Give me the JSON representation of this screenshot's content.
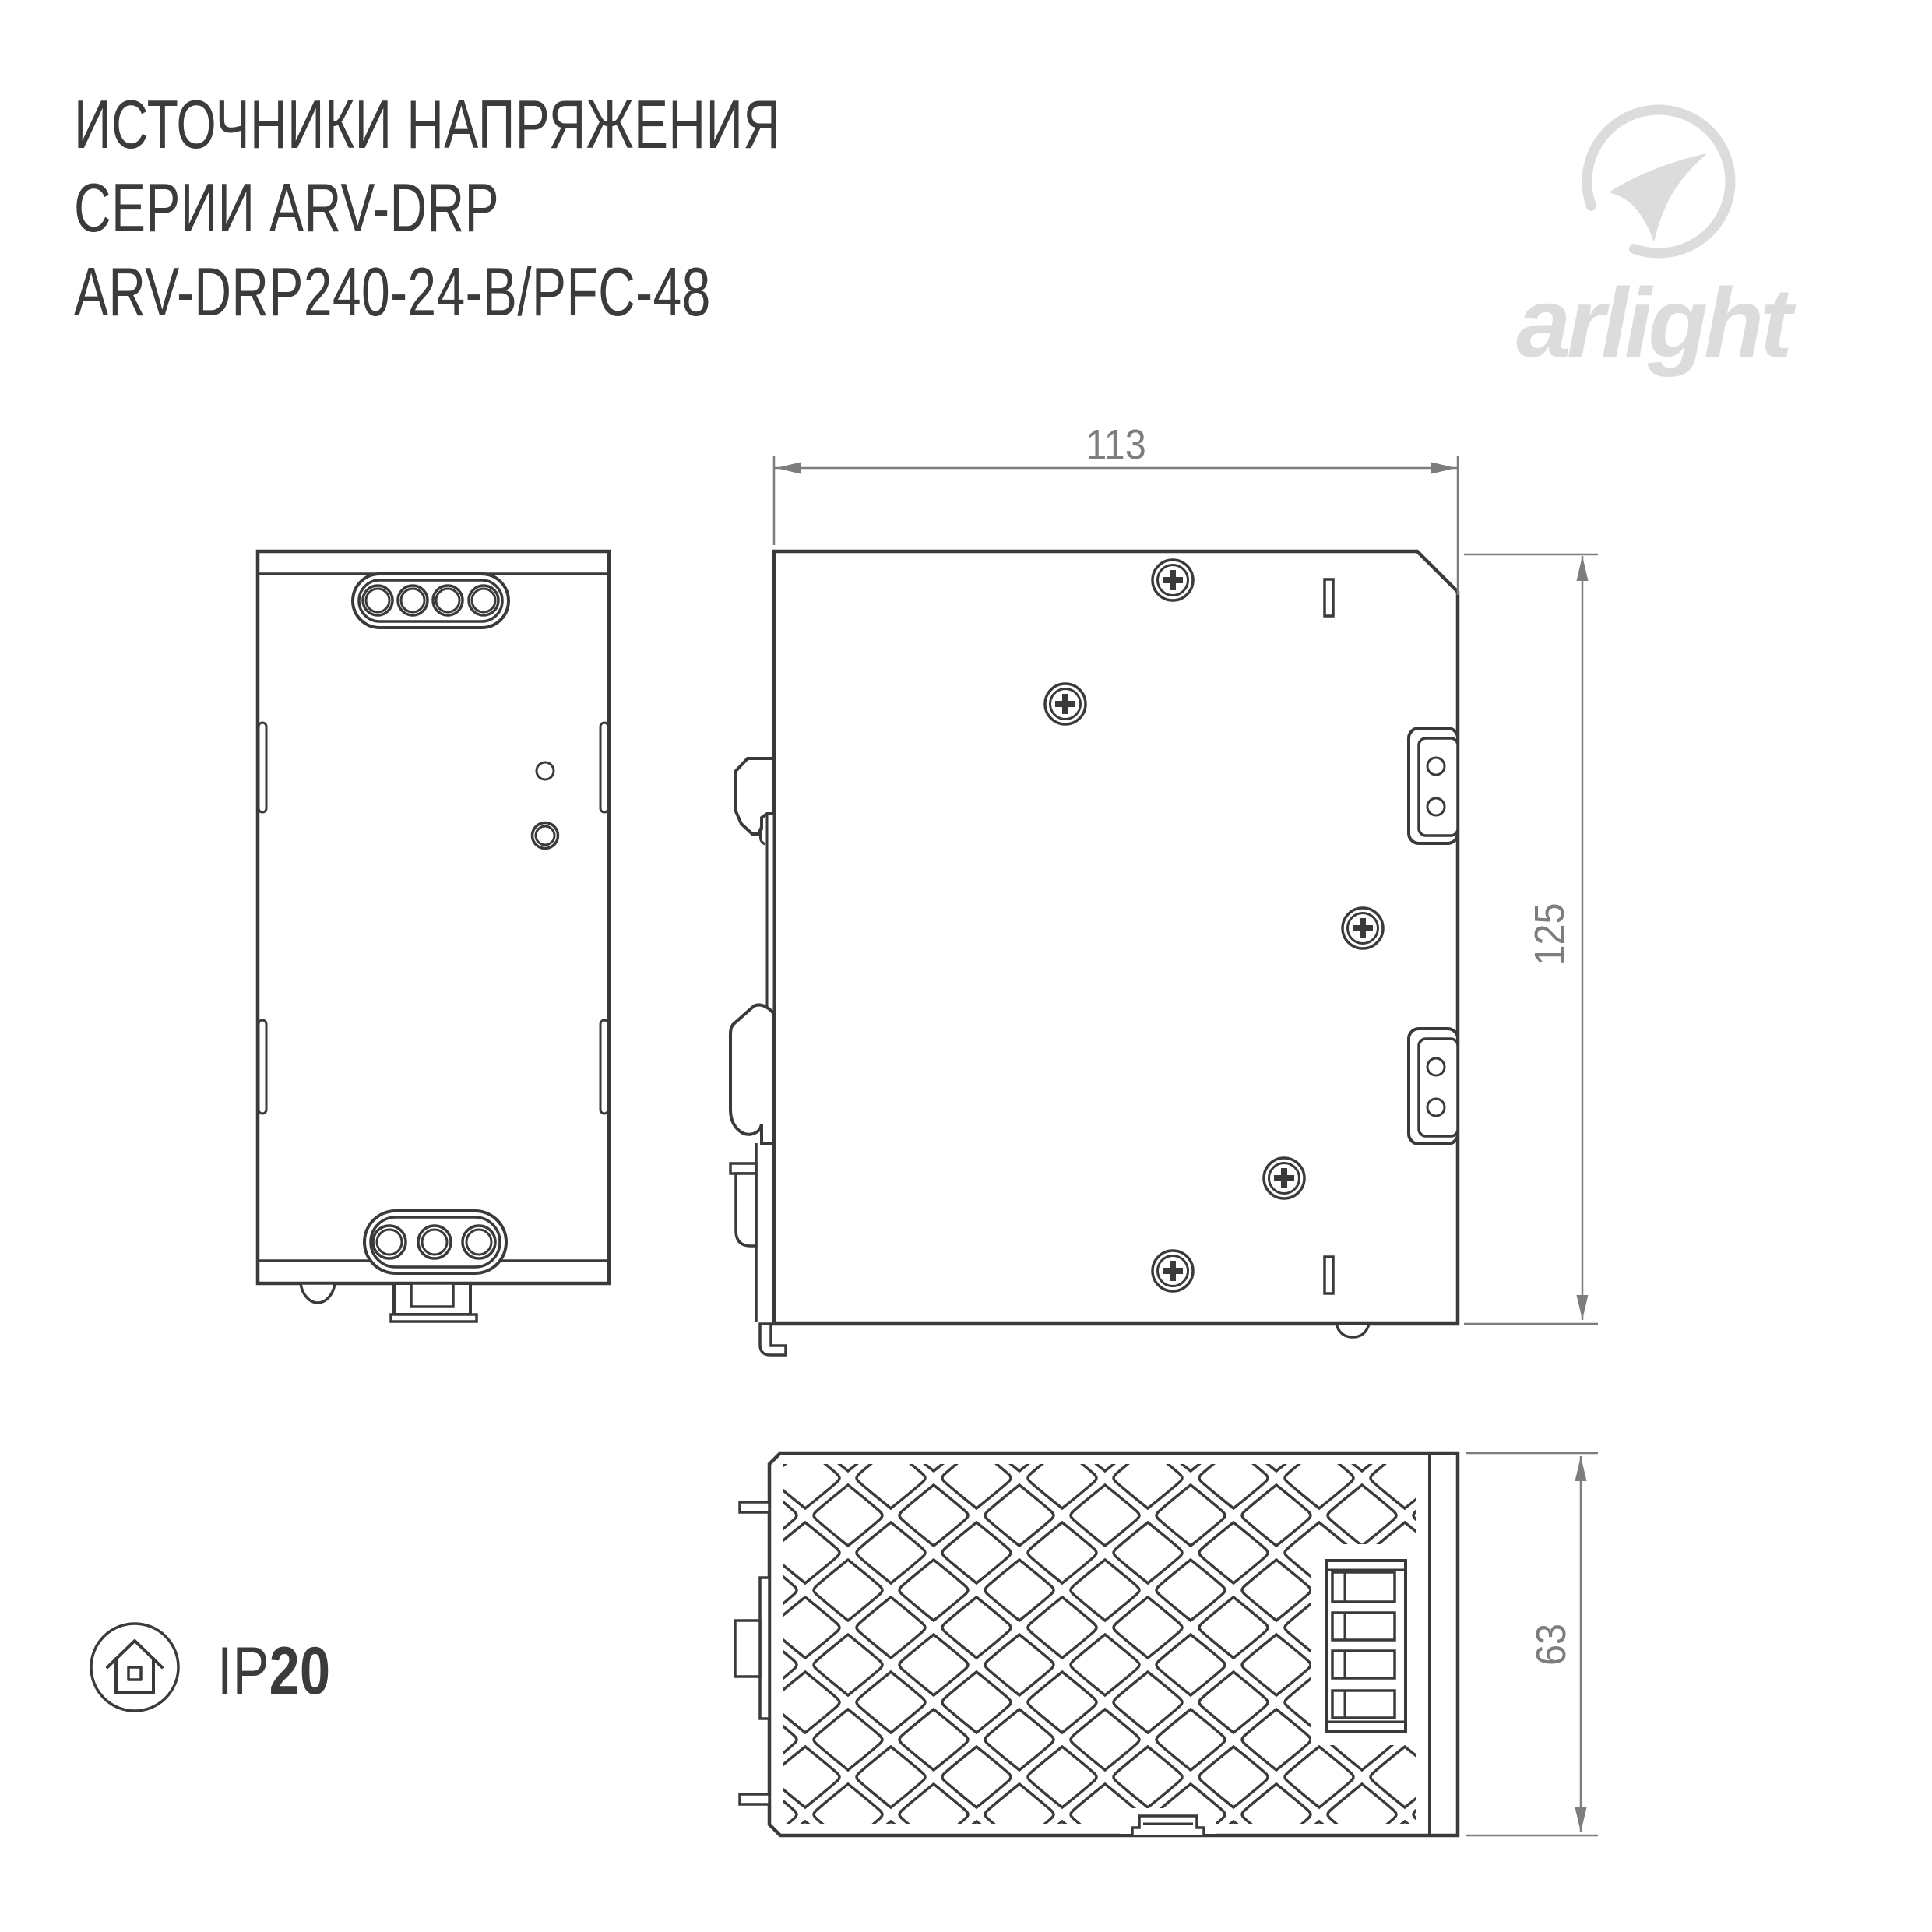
{
  "header": {
    "title_line1": "ИСТОЧНИКИ НАПРЯЖЕНИЯ",
    "title_line2": "СЕРИИ ARV-DRP",
    "title_line3": "ARV-DRP240-24-B/PFC-48"
  },
  "logo": {
    "brand": "arlight",
    "mark_icon": "arlight-swoosh-circle-icon"
  },
  "drawing": {
    "views": [
      "front-view",
      "side-view",
      "bottom-view"
    ],
    "dim_width_label": "113",
    "dim_height_label": "125",
    "dim_depth_label": "63"
  },
  "ip_rating": {
    "prefix": "IP",
    "value": "20",
    "icon": "house-enclosure-icon"
  },
  "colors": {
    "background": "#ffffff",
    "line": "#3a3a3a",
    "dimension": "#7d7d7d",
    "logo": "#dcdcdc",
    "text": "#3b3b3b"
  }
}
